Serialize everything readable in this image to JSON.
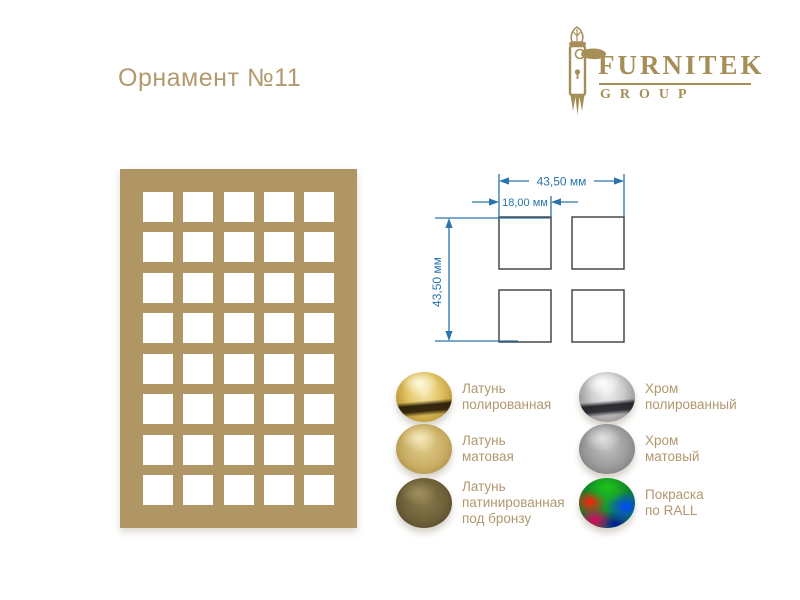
{
  "title": "Орнамент №11",
  "logo": {
    "name": "FURNITEK",
    "subtitle": "GROUP"
  },
  "ornament": {
    "rows": 8,
    "cols": 5,
    "color": "#b09664"
  },
  "dimensions": {
    "width_label": "43,50 мм",
    "spacing_label": "18,00 мм",
    "height_label": "43,50 мм"
  },
  "finishes": {
    "left": [
      {
        "name": "brass-polished",
        "label": "Латунь\nполированная"
      },
      {
        "name": "brass-matte",
        "label": "Латунь\nматовая"
      },
      {
        "name": "brass-patinated",
        "label": "Латунь\nпатинированная\nпод бронзу"
      }
    ],
    "right": [
      {
        "name": "chrome-polished",
        "label": "Хром\nполированный"
      },
      {
        "name": "chrome-matte",
        "label": "Хром\nматовый"
      },
      {
        "name": "ral-paint",
        "label": "Покраска\nпо RALL"
      }
    ]
  },
  "colors": {
    "accent_tan": "#b09664",
    "title_text": "#b39a6c",
    "label_text": "#b1976e",
    "logo_gold": "#a68e58",
    "dimension_blue": "#2874ab",
    "square_stroke": "#3c3c3c"
  }
}
